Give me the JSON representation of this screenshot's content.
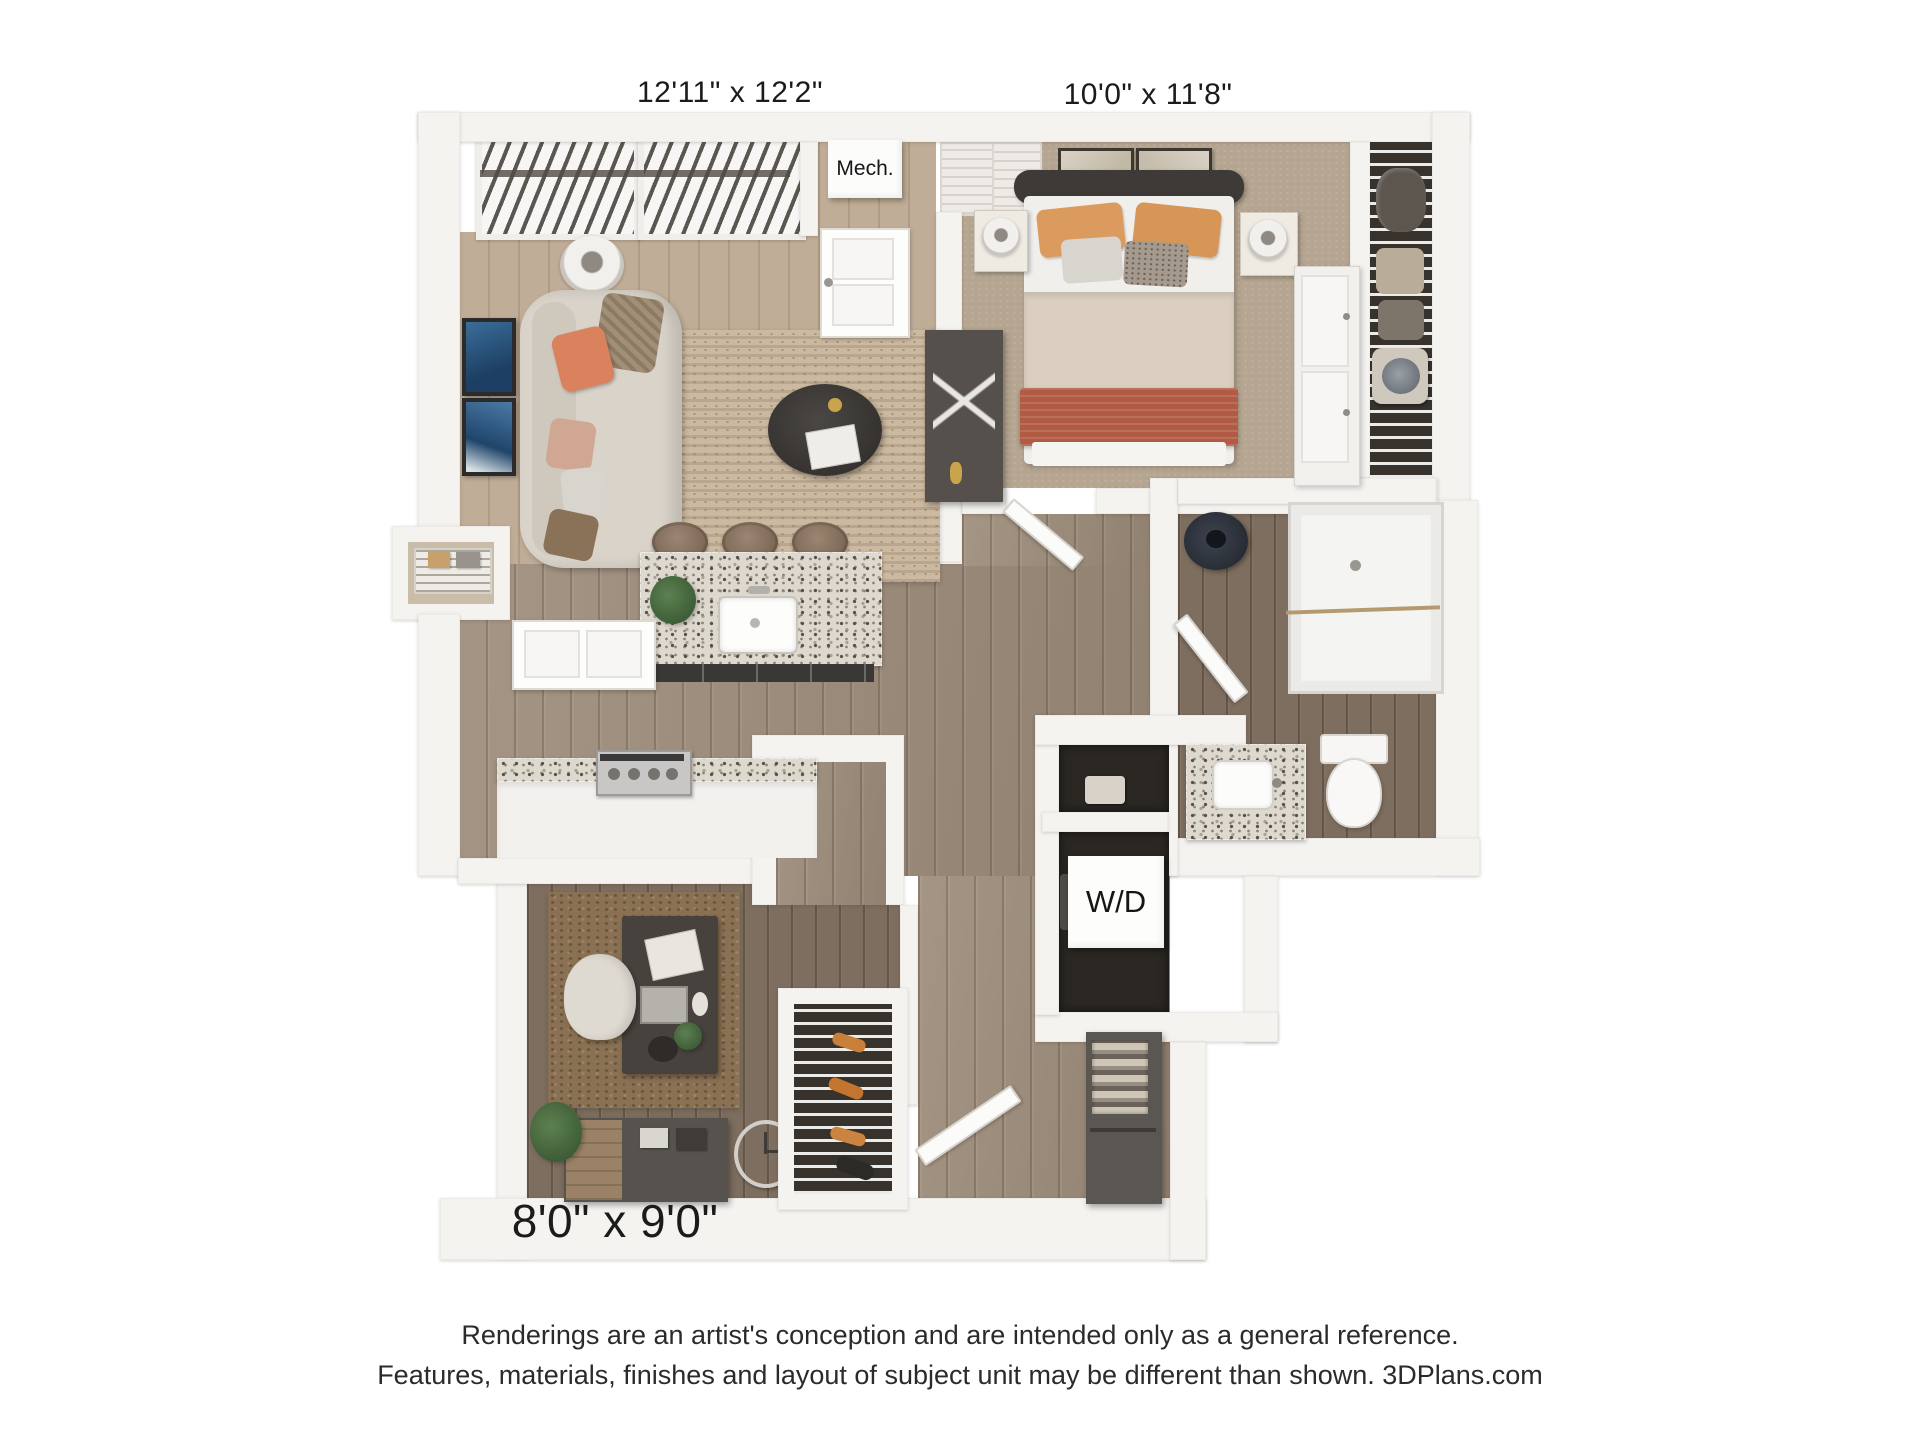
{
  "rooms": [
    {
      "name": "living-dining",
      "dimensions": "12'11\" x 12'2\""
    },
    {
      "name": "bedroom",
      "dimensions": "10'0\" x 11'8\""
    },
    {
      "name": "den-office",
      "dimensions": "8'0\" x 9'0\""
    }
  ],
  "annotations": {
    "mech_closet": "Mech.",
    "washer_dryer": "W/D"
  },
  "disclaimer": {
    "line1": "Renderings are an artist's conception and are intended only as a general reference.",
    "line2": "Features, materials, finishes and layout of subject unit may be different than shown. 3DPlans.com"
  },
  "colors": {
    "background": "#ffffff",
    "wall": "#f5f3f0",
    "wood_floor": "#9d8c7a",
    "wood_floor_dark": "#7e6e5f",
    "bedroom_carpet": "#b5a591",
    "living_rug": "#cbbaa1",
    "office_rug": "#8b7153",
    "granite": "#ded9ce",
    "dark_furniture": "#433f3b",
    "accent_terracotta": "#b15b44",
    "accent_orange": "#dc9b5e",
    "label_text": "#1b1b1b"
  }
}
